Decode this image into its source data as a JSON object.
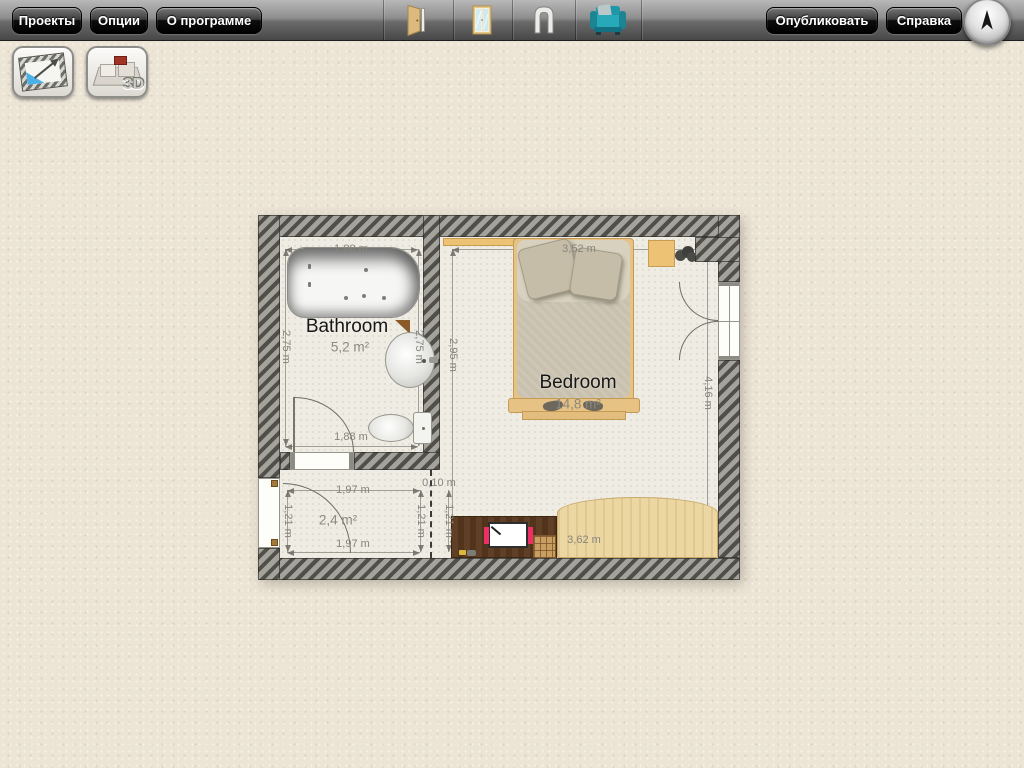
{
  "toolbar": {
    "left_buttons": [
      {
        "label": "Проекты"
      },
      {
        "label": "Опции"
      },
      {
        "label": "О программе"
      }
    ],
    "right_buttons": [
      {
        "label": "Опубликовать"
      },
      {
        "label": "Справка"
      }
    ],
    "tool_icons": [
      {
        "name": "door-icon"
      },
      {
        "name": "window-icon"
      },
      {
        "name": "arch-opening-icon"
      },
      {
        "name": "armchair-icon"
      }
    ],
    "compass_icon": "north-arrow-icon"
  },
  "view_switcher": {
    "plan_2d_icon": "2d-plan-icon",
    "view_3d_icon": "3d-view-icon",
    "label_3d": "3D"
  },
  "floorplan": {
    "bathroom": {
      "name": "Bathroom",
      "area": "5,2 m²",
      "dim_top": "1,88 m",
      "dim_bottom": "1,88 m",
      "dim_left": "2,75 m",
      "dim_right": "2,75 m"
    },
    "bedroom": {
      "name": "Bedroom",
      "area": "14,8 m²",
      "dim_top": "3,52 m",
      "dim_bottom": "3,62 m",
      "dim_left": "2,95 m",
      "dim_right": "4,16 m"
    },
    "hallway": {
      "area": "2,4 m²",
      "dim_top": "1,97 m",
      "dim_bottom": "1,97 m",
      "dim_left": "1,21 m",
      "dim_right": "1,21 m",
      "dim_right_outer": "1,21 m",
      "dim_gap": "0,10 m"
    }
  },
  "colors": {
    "accent_teal": "#1FA0B0",
    "wall_light": "#A3A29B",
    "wall_dark": "#504F49",
    "canvas_bg": "#ECE4D5",
    "wood_desk": "#5F3F25",
    "wood_wardrobe": "#ECD7A2",
    "bed_frame": "#E6C285"
  }
}
